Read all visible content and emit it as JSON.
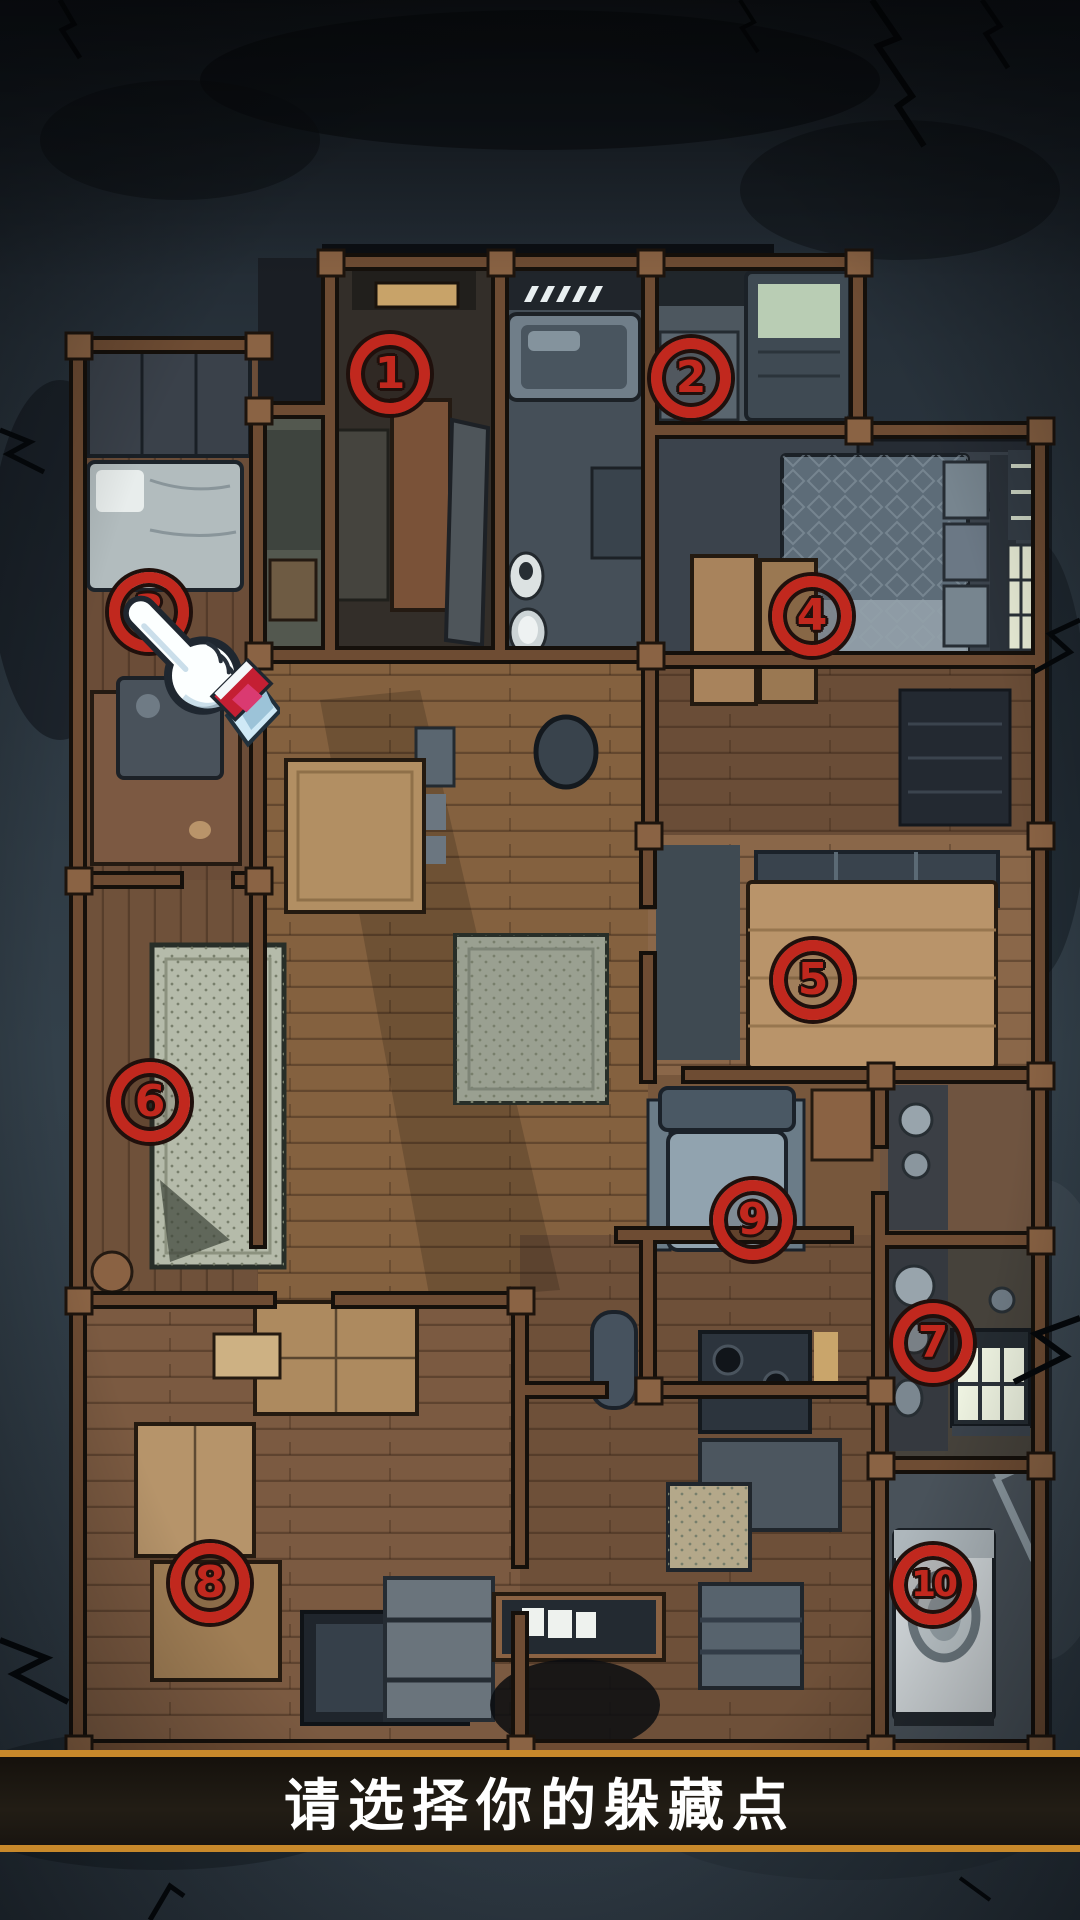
{
  "screen": {
    "width": 1080,
    "height": 1920,
    "description": "top-down haunted house floor plan with numbered hiding spots"
  },
  "prompt": {
    "text": "请选择你的躲藏点"
  },
  "markers": [
    {
      "id": 1,
      "label": "1",
      "x": 390,
      "y": 374
    },
    {
      "id": 2,
      "label": "2",
      "x": 691,
      "y": 378
    },
    {
      "id": 3,
      "label": "3",
      "x": 149,
      "y": 612
    },
    {
      "id": 4,
      "label": "4",
      "x": 812,
      "y": 616
    },
    {
      "id": 5,
      "label": "5",
      "x": 813,
      "y": 980
    },
    {
      "id": 6,
      "label": "6",
      "x": 150,
      "y": 1102
    },
    {
      "id": 7,
      "label": "7",
      "x": 933,
      "y": 1343
    },
    {
      "id": 8,
      "label": "8",
      "x": 210,
      "y": 1583
    },
    {
      "id": 9,
      "label": "9",
      "x": 753,
      "y": 1220
    },
    {
      "id": 10,
      "label": "10",
      "x": 933,
      "y": 1585
    }
  ],
  "cursor": {
    "icon": "hand-pointer-icon",
    "points_at_marker": "3",
    "x": 142,
    "y": 610
  },
  "colors": {
    "marker_red": "#c1281e",
    "marker_outline": "#20100c",
    "bar_border_gold": "#c8892b",
    "bar_background": "#17130e",
    "prompt_text": "#ffffff",
    "background_slate": "#2d3842"
  }
}
